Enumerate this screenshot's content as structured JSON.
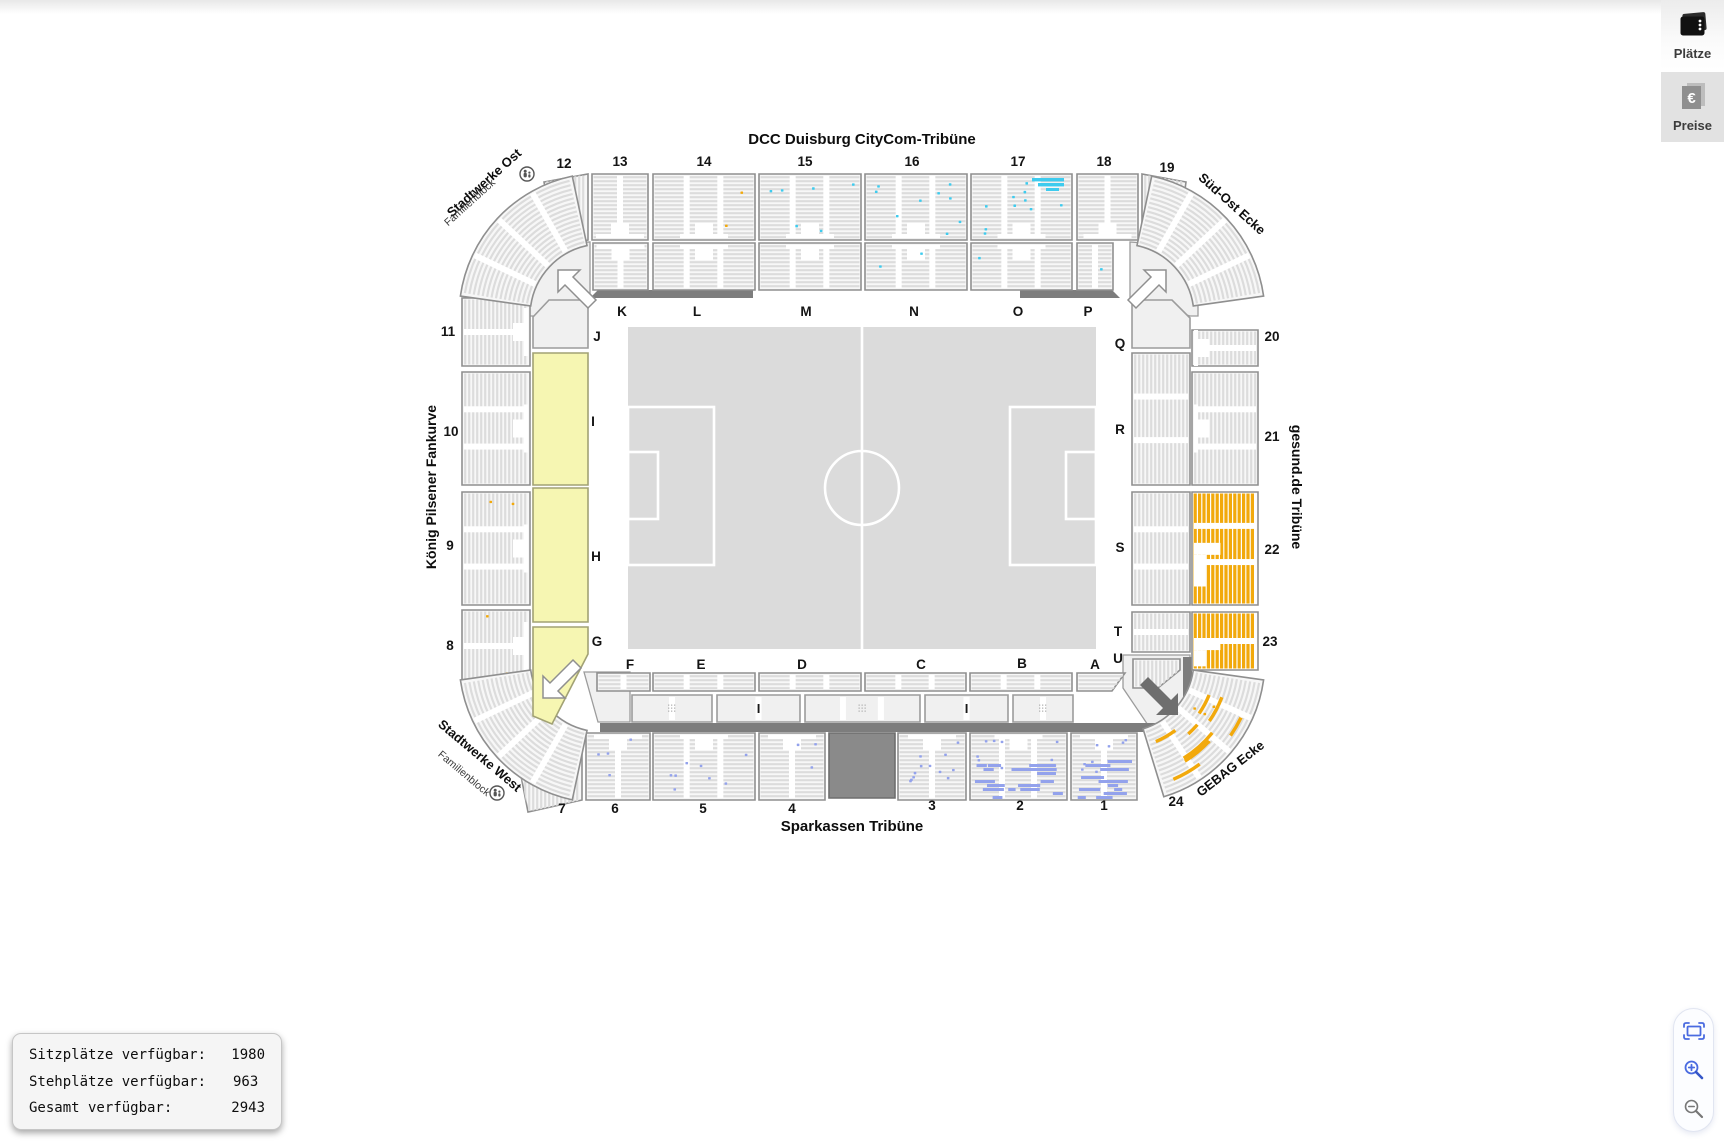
{
  "toolbar": {
    "places_label": "Plätze",
    "places_icon": "seatmap-icon",
    "prices_label": "Preise",
    "prices_icon": "euro-prices-icon"
  },
  "stands": {
    "north": "DCC Duisburg CityCom-Tribüne",
    "south": "Sparkassen Tribüne",
    "west": "König Pilsener Fankurve",
    "east": "gesund.de Tribüne",
    "northwest": {
      "name": "Stadtwerke Ost",
      "sub": "Familienblock",
      "icon": "family-icon"
    },
    "northeast": {
      "name": "Süd-Ost Ecke"
    },
    "southwest": {
      "name": "Stadtwerke West",
      "sub": "Familienblock",
      "icon": "family-icon"
    },
    "southeast": {
      "name": "GEBAG Ecke"
    }
  },
  "availability_panel": {
    "rows": [
      {
        "label": "Sitzplätze verfügbar:",
        "value": "1980"
      },
      {
        "label": "Stehplätze verfügbar:",
        "value": "963"
      },
      {
        "label": "Gesamt verfügbar:",
        "value": "2943"
      }
    ]
  },
  "palette": {
    "standing_available": "#f6f6b2",
    "category_orange": "#f2a90b",
    "category_blue": "#93a2ec",
    "category_cyan": "#3ecbee",
    "closed_block": "#8a8a8a"
  },
  "zoom_controls": {
    "fit_icon": "fit-view-icon",
    "zoom_in_icon": "zoom-in-icon",
    "zoom_out_icon": "zoom-out-icon"
  },
  "map": {
    "outer_blocks": [
      {
        "id": "1",
        "label": "1",
        "marks": {
          "color": "blue",
          "style": "heavy",
          "count": 14
        }
      },
      {
        "id": "2",
        "label": "2",
        "marks": {
          "color": "blue",
          "style": "heavy",
          "count": 16
        }
      },
      {
        "id": "3",
        "label": "3",
        "marks": {
          "color": "blue",
          "style": "scatter",
          "count": 12
        }
      },
      {
        "id": "4",
        "label": "4",
        "marks": {
          "color": "blue",
          "style": "scatter",
          "count": 3
        }
      },
      {
        "id": "5",
        "label": "5",
        "marks": {
          "color": "blue",
          "style": "scatter",
          "count": 8
        }
      },
      {
        "id": "6",
        "label": "6",
        "marks": {
          "color": "blue",
          "style": "scatter",
          "count": 4
        }
      },
      {
        "id": "7",
        "label": "7",
        "marks": {
          "color": "blue",
          "style": "scatter",
          "count": 1
        }
      },
      {
        "id": "8",
        "label": "8",
        "marks": {
          "color": "orange",
          "style": "scatter",
          "count": 2
        }
      },
      {
        "id": "9",
        "label": "9",
        "marks": {
          "color": "orange",
          "style": "scatter",
          "count": 2
        }
      },
      {
        "id": "10",
        "label": "10"
      },
      {
        "id": "11",
        "label": "11"
      },
      {
        "id": "12",
        "label": "12"
      },
      {
        "id": "13",
        "label": "13"
      },
      {
        "id": "14",
        "label": "14",
        "marks": {
          "color": "orange",
          "style": "scatter",
          "count": 2
        }
      },
      {
        "id": "15",
        "label": "15",
        "marks": {
          "color": "cyan",
          "style": "scatter",
          "count": 6
        }
      },
      {
        "id": "16",
        "label": "16",
        "marks": {
          "color": "cyan",
          "style": "scatter",
          "count": 9
        }
      },
      {
        "id": "17",
        "label": "17",
        "marks": {
          "color": "cyan",
          "style": "cluster",
          "count": 10
        }
      },
      {
        "id": "18",
        "label": "18"
      },
      {
        "id": "19",
        "label": "19"
      },
      {
        "id": "20",
        "label": "20"
      },
      {
        "id": "21",
        "label": "21"
      },
      {
        "id": "22",
        "label": "22",
        "marks": {
          "color": "orange",
          "style": "filled"
        }
      },
      {
        "id": "23",
        "label": "23",
        "marks": {
          "color": "orange",
          "style": "filled"
        }
      },
      {
        "id": "24",
        "label": "24",
        "marks": {
          "color": "orange",
          "style": "patches",
          "count": 8
        }
      },
      {
        "id": "nw-curve"
      },
      {
        "id": "ne-curve"
      },
      {
        "id": "sw-curve"
      },
      {
        "id": "closed-block"
      }
    ],
    "inner_blocks": [
      {
        "id": "K",
        "label": "K"
      },
      {
        "id": "L",
        "label": "L"
      },
      {
        "id": "M",
        "label": "M"
      },
      {
        "id": "N",
        "label": "N",
        "marks": {
          "color": "cyan",
          "style": "scatter",
          "count": 2
        }
      },
      {
        "id": "O",
        "label": "O",
        "marks": {
          "color": "cyan",
          "style": "scatter",
          "count": 1
        }
      },
      {
        "id": "P",
        "label": "P",
        "marks": {
          "color": "cyan",
          "style": "scatter",
          "count": 1
        }
      },
      {
        "id": "J",
        "label": "J"
      },
      {
        "id": "I",
        "label": "I",
        "standing": true
      },
      {
        "id": "H",
        "label": "H",
        "standing": true
      },
      {
        "id": "G",
        "label": "G",
        "standing": true
      },
      {
        "id": "Q",
        "label": "Q"
      },
      {
        "id": "R",
        "label": "R"
      },
      {
        "id": "S",
        "label": "S"
      },
      {
        "id": "T",
        "label": "T"
      },
      {
        "id": "U",
        "label": "U"
      },
      {
        "id": "F",
        "label": "F"
      },
      {
        "id": "E",
        "label": "E"
      },
      {
        "id": "D",
        "label": "D"
      },
      {
        "id": "C",
        "label": "C"
      },
      {
        "id": "B",
        "label": "B"
      },
      {
        "id": "A",
        "label": "A"
      },
      {
        "id": "mb1"
      },
      {
        "id": "mb2",
        "gantry": "I"
      },
      {
        "id": "mb3"
      },
      {
        "id": "mb4",
        "gantry": "I"
      },
      {
        "id": "mb5"
      }
    ]
  }
}
